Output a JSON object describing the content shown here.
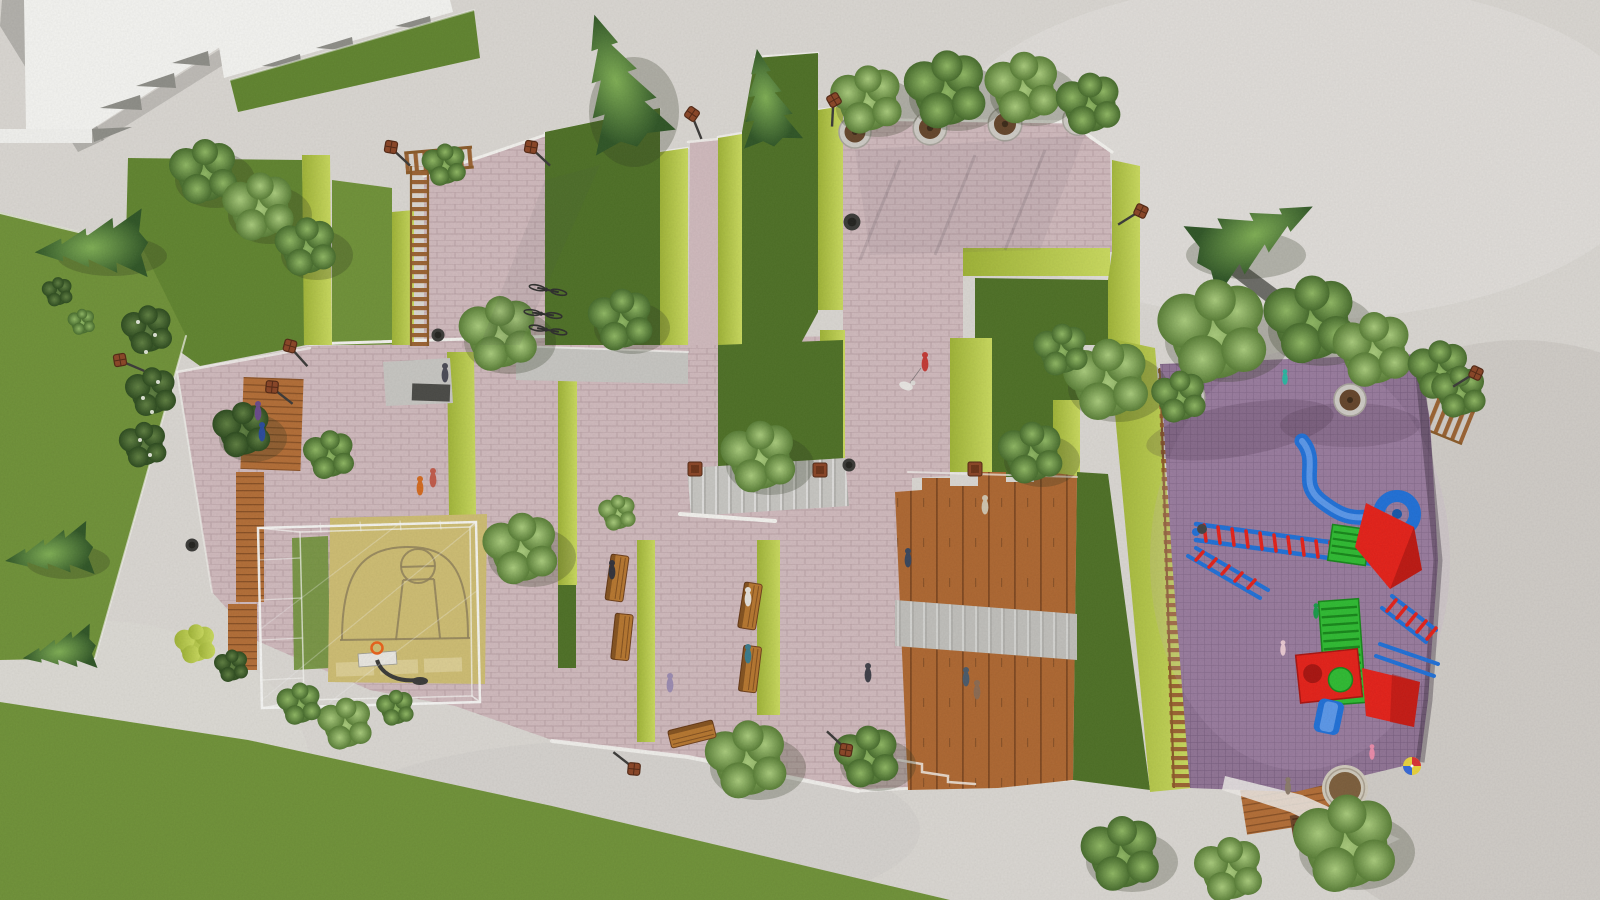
{
  "scene": {
    "setting": "Top-down aerial 3D rendering of a landscaped public park plaza",
    "style": "architectural visualization, no text or UI elements visible"
  },
  "colors": {
    "gravel": "#d9d6d1",
    "gravel_dark": "#c7c4bf",
    "building_roof": "#f3f3f0",
    "building_tooth": "#8d8d87",
    "wall_gray": "#b2b0ab",
    "grass": "#6f9138",
    "grass_dark": "#4e7026",
    "grass_hill": "#60842f",
    "hedge_lime_a": "#c9d95e",
    "hedge_lime_b": "#9eb236",
    "pavement_pink": "#cfb9bc",
    "concrete": "#c6c5c1",
    "curb_white": "#f2f1ed",
    "wood": "#b26d36",
    "wood_terrace": "#ad6731",
    "wood_dark": "#8a5a28",
    "court": "#cdbc72",
    "court_line": "#8f815a",
    "court_block": "#dbcd92",
    "cage_white": "#f6f6f3",
    "playground_purple": "#8f7394",
    "play_red": "#e32119",
    "play_red_dark": "#a81410",
    "play_blue": "#2070d6",
    "play_blue_light": "#5b97e8",
    "play_green": "#2fba32",
    "play_green_dark": "#17861a",
    "sand": "#7c5e3c",
    "sand_rim": "#cfc9bb",
    "lamp_rust": "#8a4526",
    "pole_dark": "#3b3a38",
    "basketball_orange": "#e8611a",
    "shadow": "rgba(45,55,30,0.26)"
  },
  "features": [
    "paved pink plaza terraces",
    "zigzag lime hedges",
    "lawns with conifer trees",
    "caged basketball half-court",
    "wooden amphitheater steps with concrete band",
    "children playground on purple safety paving",
    "blue spiral slide",
    "red climbing houses",
    "green climbing tower",
    "wooden ladder fences",
    "pergola trellis",
    "bicycle parking",
    "timber benches",
    "street lamps",
    "potted trees",
    "round sand pit",
    "flowering shrubs",
    "pedestrians and children"
  ]
}
